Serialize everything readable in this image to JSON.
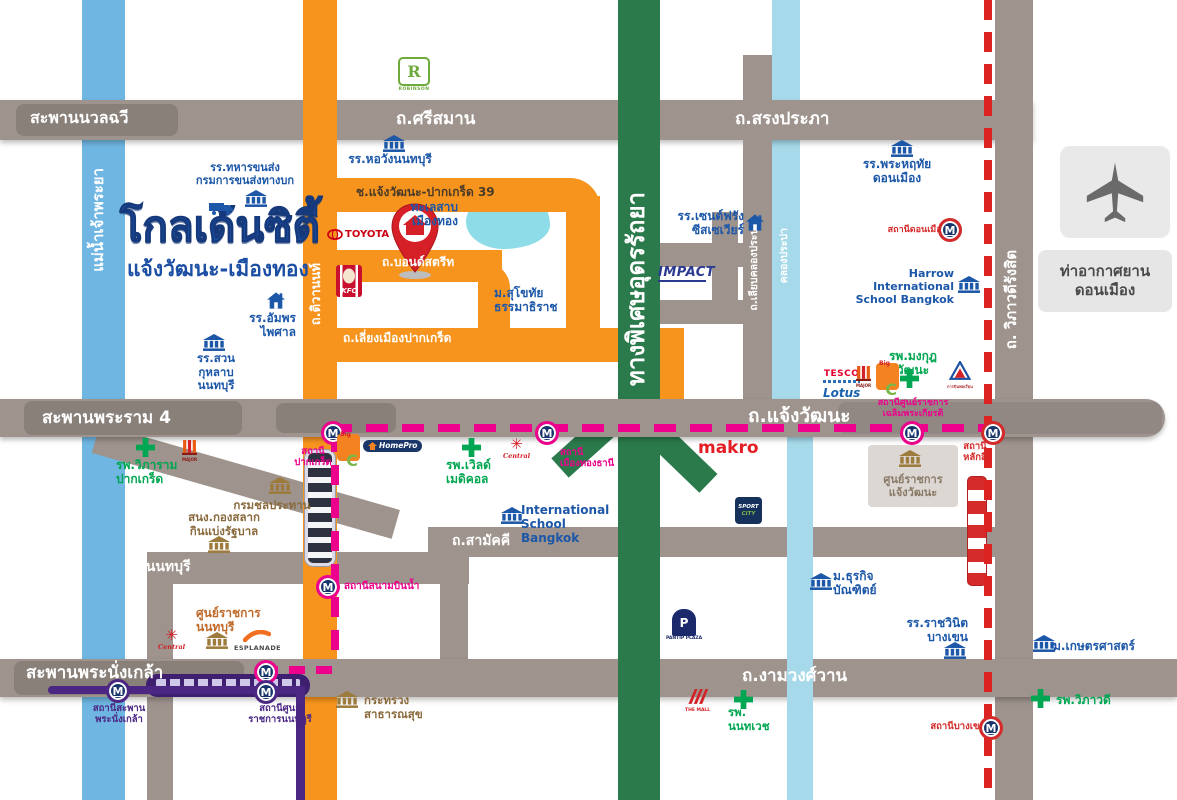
{
  "logo": {
    "title": "โกลเด้นซิตี้",
    "subtitle": "แจ้งวัฒนะ-เมืองทอง"
  },
  "airport": {
    "label": "ท่าอากาศยาน\nดอนเมือง"
  },
  "colors": {
    "white": "#ffffff",
    "road": "#9e938d",
    "orange": "#f7941e",
    "green": "#2b7a4b",
    "river": "#6fb6e2",
    "canal": "#a6d9ea",
    "pink": "#ec008c",
    "purple": "#4b2683",
    "red": "#d42a2a",
    "blue": "#1c57a8",
    "hospital": "#00a651",
    "gov": "#8a6a3c"
  },
  "labels": [
    {
      "id": "bridge-nuanchawee-label",
      "t": "สะพานนวลฉวี",
      "x": 30,
      "y": 109,
      "s": 16,
      "c": "white"
    },
    {
      "id": "road-srisaman-label",
      "t": "ถ.ศรีสมาน",
      "x": 396,
      "y": 109,
      "s": 17,
      "c": "white"
    },
    {
      "id": "road-songprapha-label",
      "t": "ถ.สรงประภา",
      "x": 735,
      "y": 109,
      "s": 17,
      "c": "white"
    },
    {
      "id": "bridge-rama4-label",
      "t": "สะพานพระราม 4",
      "x": 42,
      "y": 408,
      "s": 17,
      "c": "white"
    },
    {
      "id": "road-chaengwattana-label",
      "t": "ถ.แจ้งวัฒนะ",
      "x": 748,
      "y": 405,
      "s": 19,
      "c": "white"
    },
    {
      "id": "road-samakkhi-label",
      "t": "ถ.สามัคคี",
      "x": 452,
      "y": 533,
      "s": 14,
      "c": "white"
    },
    {
      "id": "road-nonthaburi-label",
      "t": "ถ.นนทบุรี",
      "x": 132,
      "y": 559,
      "s": 14,
      "c": "white"
    },
    {
      "id": "bridge-phranangklao-label",
      "t": "สะพานพระนั่งเกล้า",
      "x": 26,
      "y": 663,
      "s": 17,
      "c": "white"
    },
    {
      "id": "road-ngamwongwan-label",
      "t": "ถ.งามวงศ์วาน",
      "x": 742,
      "y": 666,
      "s": 17,
      "c": "white"
    },
    {
      "id": "road-soi39-label",
      "t": "ช.แจ้งวัฒนะ-ปากเกร็ด 39",
      "x": 356,
      "y": 185,
      "s": 12,
      "c": "#4a3b28"
    },
    {
      "id": "road-bondstreet-label",
      "t": "ถ.บอนด์สตรีท",
      "x": 382,
      "y": 255,
      "s": 12,
      "c": "white"
    },
    {
      "id": "road-liangmueang-label",
      "t": "ถ.เลี่ยงเมืองปากเกร็ด",
      "x": 343,
      "y": 331,
      "s": 12,
      "c": "white"
    },
    {
      "id": "river-chaophraya-label",
      "t": "แม่น้ำเจ้าพระยา",
      "x": 90,
      "y": 168,
      "s": 15,
      "c": "white",
      "rot": 1
    },
    {
      "id": "road-tiwanon-label",
      "t": "ถ.ติวานนท์",
      "x": 309,
      "y": 263,
      "s": 13,
      "c": "white",
      "rot": 1
    },
    {
      "id": "expressway-udonratthaya-label",
      "t": "ทางพิเศษอุดรรัถยา",
      "x": 622,
      "y": 192,
      "s": 24,
      "c": "white",
      "rot": 1
    },
    {
      "id": "road-liabklongprapa-label",
      "t": "ถ.เลียบคลองประปา",
      "x": 748,
      "y": 222,
      "s": 10.5,
      "c": "white",
      "rot": 1
    },
    {
      "id": "canal-klongprapa-label",
      "t": "คลองประปา",
      "x": 778,
      "y": 228,
      "s": 10.5,
      "c": "white",
      "rot": 1
    },
    {
      "id": "road-vibhavadi-label",
      "t": "ถ. วิภาวดีรังสิต",
      "x": 1003,
      "y": 250,
      "s": 15,
      "c": "white",
      "rot": 1
    },
    {
      "id": "landmark-horwang-school",
      "t": "รร.หอวังนนทบุรี",
      "x": 340,
      "y": 152,
      "w": 100,
      "s": 12,
      "c": "blue",
      "a": "center"
    },
    {
      "id": "landmark-military-transport-school",
      "t": "รร.ทหารขนส่ง\nกรมการขนส่งทางบก",
      "x": 188,
      "y": 162,
      "w": 114,
      "s": 11,
      "c": "blue",
      "a": "center"
    },
    {
      "id": "landmark-phrahruethai-school",
      "t": "รร.พระหฤทัย\nดอนเมือง",
      "x": 853,
      "y": 157,
      "w": 88,
      "s": 12,
      "c": "blue",
      "a": "center"
    },
    {
      "id": "landmark-stfrancis-school",
      "t": "รร.เซนต์ฟรัง\nซีสเซเวียร์",
      "x": 664,
      "y": 209,
      "w": 80,
      "s": 12,
      "c": "blue",
      "a": "right"
    },
    {
      "id": "landmark-harrow-school",
      "t": "Harrow International\nSchool Bangkok",
      "x": 834,
      "y": 268,
      "w": 120,
      "s": 11,
      "c": "blue",
      "a": "right"
    },
    {
      "id": "landmark-sukhothai-university",
      "t": "ม.สุโขทัย\nธรรมาธิราช",
      "x": 494,
      "y": 286,
      "w": 72,
      "s": 12,
      "c": "blue"
    },
    {
      "id": "landmark-amphon-school",
      "t": "รร.อัมพร\nไพศาล",
      "x": 228,
      "y": 311,
      "w": 68,
      "s": 12,
      "c": "blue",
      "a": "right"
    },
    {
      "id": "landmark-suankularb-school",
      "t": "รร.สวน\nกุหลาบ\nนนทบุรี",
      "x": 186,
      "y": 352,
      "w": 60,
      "s": 11.5,
      "c": "blue",
      "a": "center"
    },
    {
      "id": "landmark-muangthong-lake",
      "t": "ทะเลสาบ\nเมืองทอง",
      "x": 394,
      "y": 200,
      "w": 64,
      "s": 12,
      "c": "blue",
      "a": "right"
    },
    {
      "id": "landmark-isb-school",
      "t": "International\nSchool Bangkok",
      "x": 521,
      "y": 503,
      "w": 95,
      "s": 12,
      "c": "blue"
    },
    {
      "id": "landmark-dhurakij-university",
      "t": "ม.ธุรกิจ\nบัณฑิตย์",
      "x": 833,
      "y": 569,
      "w": 58,
      "s": 12,
      "c": "blue"
    },
    {
      "id": "landmark-rajavinit-school",
      "t": "รร.ราชวินิต\nบางเขน",
      "x": 896,
      "y": 616,
      "w": 72,
      "s": 12,
      "c": "blue",
      "a": "right"
    },
    {
      "id": "landmark-kasetsart-university",
      "t": "ม.เกษตรศาสตร์",
      "x": 1053,
      "y": 639,
      "w": 100,
      "s": 12,
      "c": "blue"
    },
    {
      "id": "landmark-viphuram-hospital",
      "t": "รพ.วิภาราม\nปากเกร็ด",
      "x": 116,
      "y": 458,
      "w": 74,
      "s": 12,
      "c": "hospital"
    },
    {
      "id": "landmark-worldmedical-hospital",
      "t": "รพ.เวิลด์\nเมดิคอล",
      "x": 446,
      "y": 458,
      "w": 62,
      "s": 12,
      "c": "hospital"
    },
    {
      "id": "landmark-mongkut-hospital",
      "t": "รพ.มงกุฎ\nวัฒนะ",
      "x": 882,
      "y": 349,
      "w": 62,
      "s": 12,
      "c": "hospital",
      "a": "center"
    },
    {
      "id": "landmark-nonthavej-hospital",
      "t": "รพ.\nนนทเวช",
      "x": 728,
      "y": 706,
      "w": 50,
      "s": 11.5,
      "c": "hospital"
    },
    {
      "id": "landmark-vibhavadi-hospital",
      "t": "รพ.วิภาวดี",
      "x": 1056,
      "y": 693,
      "w": 72,
      "s": 12,
      "c": "hospital"
    },
    {
      "id": "landmark-royal-irrigation",
      "t": "กรมชลประทาน",
      "x": 222,
      "y": 499,
      "w": 100,
      "s": 11.5,
      "c": "gov",
      "a": "center"
    },
    {
      "id": "landmark-lottery-office",
      "t": "สนง.กองสลาก\nกินแบ่งรัฐบาล",
      "x": 180,
      "y": 511,
      "w": 88,
      "s": 11.5,
      "c": "gov",
      "a": "center"
    },
    {
      "id": "landmark-health-ministry",
      "t": "กระทรวง\nสาธารณสุข",
      "x": 364,
      "y": 694,
      "w": 72,
      "s": 11.5,
      "c": "gov"
    },
    {
      "id": "landmark-government-complex-cw",
      "t": "ศูนย์ราชการ\nแจ้งวัฒนะ",
      "x": 872,
      "y": 474,
      "w": 82,
      "s": 11,
      "c": "#8a7a66",
      "a": "center"
    },
    {
      "id": "landmark-government-complex-nb",
      "t": "ศูนย์ราชการ\nนนทบุรี",
      "x": 196,
      "y": 606,
      "w": 72,
      "s": 12,
      "c": "#c06a2a"
    },
    {
      "id": "station-pakkred-label",
      "t": "สถานี\nปากเกร็ด",
      "x": 291,
      "y": 446,
      "w": 44,
      "s": 9.5,
      "c": "pink",
      "a": "center"
    },
    {
      "id": "station-mueangthongthani-label",
      "t": "สถานี\nเมืองทองธานี",
      "x": 560,
      "y": 447,
      "w": 62,
      "s": 9.5,
      "c": "pink"
    },
    {
      "id": "station-chalermprakiat-label",
      "t": "สถานีศูนย์ราชการ\nเฉลิมพระเกียรติ",
      "x": 866,
      "y": 398,
      "w": 94,
      "s": 9,
      "c": "pink",
      "a": "center"
    },
    {
      "id": "station-sanambinnam-label",
      "t": "สถานีสนามบินน้ำ",
      "x": 344,
      "y": 581,
      "w": 92,
      "s": 10,
      "c": "pink"
    },
    {
      "id": "station-phranangklao-label",
      "t": "สถานีสะพาน\nพระนั่งเกล้า",
      "x": 82,
      "y": 703,
      "w": 74,
      "s": 9.5,
      "c": "purple",
      "a": "center"
    },
    {
      "id": "station-civic-nonthaburi-label",
      "t": "สถานีศูนย์\nราชการนนทบุรี",
      "x": 236,
      "y": 703,
      "w": 88,
      "s": 9.5,
      "c": "purple",
      "a": "center"
    },
    {
      "id": "station-donmueang-label",
      "t": "สถานีดอนเมือง",
      "x": 882,
      "y": 225,
      "w": 64,
      "s": 9,
      "c": "red",
      "a": "right"
    },
    {
      "id": "station-laksi-label",
      "t": "สถานี\nหลักสี่",
      "x": 954,
      "y": 441,
      "w": 42,
      "s": 9.5,
      "c": "red",
      "a": "center"
    },
    {
      "id": "station-bangkhen-label",
      "t": "สถานีบางเขน",
      "x": 922,
      "y": 721,
      "w": 64,
      "s": 9.5,
      "c": "red",
      "a": "right"
    },
    {
      "id": "logo-makro",
      "t": "makro",
      "x": 698,
      "y": 438,
      "s": 17,
      "c": "#e31e24",
      "weight": "800"
    }
  ],
  "icons": [
    {
      "id": "bank-icon-horwang",
      "kind": "bank",
      "x": 383,
      "y": 135,
      "c": "blue"
    },
    {
      "id": "bank-icon-military-transport",
      "kind": "bank",
      "x": 245,
      "y": 190,
      "c": "blue"
    },
    {
      "id": "bank-icon-phrahruethai",
      "kind": "bank",
      "x": 891,
      "y": 140,
      "c": "blue"
    },
    {
      "id": "bank-icon-harrow",
      "kind": "bank",
      "x": 958,
      "y": 276,
      "c": "blue"
    },
    {
      "id": "bank-icon-suankularb",
      "kind": "bank",
      "x": 203,
      "y": 334,
      "c": "blue"
    },
    {
      "id": "bank-icon-isb",
      "kind": "bank",
      "x": 501,
      "y": 507,
      "c": "blue"
    },
    {
      "id": "bank-icon-dhurakij",
      "kind": "bank",
      "x": 810,
      "y": 573,
      "c": "blue"
    },
    {
      "id": "bank-icon-rajavinit",
      "kind": "bank",
      "x": 944,
      "y": 642,
      "c": "blue"
    },
    {
      "id": "bank-icon-kasetsart",
      "kind": "bank",
      "x": 1033,
      "y": 635,
      "c": "blue"
    },
    {
      "id": "house-icon-stfrancis",
      "kind": "house",
      "x": 746,
      "y": 214,
      "c": "blue"
    },
    {
      "id": "house-icon-amphon",
      "kind": "house",
      "x": 267,
      "y": 292,
      "c": "blue"
    },
    {
      "id": "bank-icon-irrigation",
      "kind": "bank",
      "x": 269,
      "y": 477,
      "c": "gov"
    },
    {
      "id": "bank-icon-lottery",
      "kind": "bank",
      "x": 208,
      "y": 536,
      "c": "gov"
    },
    {
      "id": "bank-icon-health-ministry",
      "kind": "bank",
      "x": 336,
      "y": 691,
      "c": "gov"
    },
    {
      "id": "bank-icon-govcomplex-cw",
      "kind": "bank",
      "x": 899,
      "y": 450,
      "c": "gov"
    },
    {
      "id": "bank-icon-govcomplex-nb",
      "kind": "bank",
      "x": 206,
      "y": 632,
      "c": "gov"
    },
    {
      "id": "cross-icon-viphuram",
      "kind": "cross",
      "x": 136,
      "y": 438
    },
    {
      "id": "cross-icon-worldmed",
      "kind": "cross",
      "x": 462,
      "y": 438
    },
    {
      "id": "cross-icon-mongkut",
      "kind": "cross",
      "x": 900,
      "y": 369
    },
    {
      "id": "cross-icon-nonthavej",
      "kind": "cross",
      "x": 734,
      "y": 690
    },
    {
      "id": "cross-icon-vibhavadi",
      "kind": "cross",
      "x": 1031,
      "y": 689
    },
    {
      "id": "m-station-icon-pakkred",
      "kind": "m",
      "x": 321,
      "y": 421,
      "c": "pink"
    },
    {
      "id": "m-station-icon-mueangthong",
      "kind": "m",
      "x": 535,
      "y": 421,
      "c": "pink"
    },
    {
      "id": "m-station-icon-chalermprakiat",
      "kind": "m",
      "x": 900,
      "y": 421,
      "c": "pink"
    },
    {
      "id": "m-station-icon-sanambinnam",
      "kind": "m",
      "x": 316,
      "y": 575,
      "c": "pink"
    },
    {
      "id": "m-station-icon-civicnon-pink",
      "kind": "m",
      "x": 254,
      "y": 660,
      "c": "pink"
    },
    {
      "id": "m-station-icon-civicnon-purple",
      "kind": "m",
      "x": 254,
      "y": 680,
      "c": "purple"
    },
    {
      "id": "m-station-icon-phranangklao",
      "kind": "m",
      "x": 106,
      "y": 679,
      "c": "purple"
    },
    {
      "id": "m-station-icon-donmueang",
      "kind": "m",
      "x": 938,
      "y": 218,
      "c": "red"
    },
    {
      "id": "m-station-icon-laksi",
      "kind": "m",
      "x": 981,
      "y": 421,
      "c": "red"
    },
    {
      "id": "m-station-icon-bangkhen",
      "kind": "m",
      "x": 979,
      "y": 716,
      "c": "red"
    },
    {
      "id": "robinson-logo",
      "kind": "robinson",
      "x": 398,
      "y": 57,
      "text": "R",
      "text2": "ROBINSON"
    },
    {
      "id": "toyota-logo",
      "kind": "toyota",
      "x": 327,
      "y": 229,
      "text": "TOYOTA"
    },
    {
      "id": "kfc-logo",
      "kind": "kfc",
      "x": 336,
      "y": 265,
      "text": "KFC"
    },
    {
      "id": "impact-logo",
      "kind": "impact",
      "x": 658,
      "y": 263,
      "text": "IMPACT"
    },
    {
      "id": "tesco-lotus-logo",
      "kind": "tesco",
      "x": 823,
      "y": 363,
      "text": "TESCO",
      "text2": "Lotus"
    },
    {
      "id": "major-cineplex-logo-north",
      "kind": "major",
      "x": 856,
      "y": 366,
      "text": "MAJOR"
    },
    {
      "id": "bigc-logo-north",
      "kind": "bigc",
      "x": 876,
      "y": 363,
      "text": "Big",
      "text2": "C"
    },
    {
      "id": "civil-aviation-logo",
      "kind": "catc",
      "x": 947,
      "y": 361,
      "text": "การบินพลเรือน"
    },
    {
      "id": "major-cineplex-logo-west",
      "kind": "major",
      "x": 182,
      "y": 440,
      "text": "MAJOR"
    },
    {
      "id": "bigc-logo-west",
      "kind": "bigc",
      "x": 337,
      "y": 434,
      "text": "Big",
      "text2": "C"
    },
    {
      "id": "homepro-logo",
      "kind": "homepro",
      "x": 363,
      "y": 440,
      "text": "HomePro"
    },
    {
      "id": "central-logo-worldmed",
      "kind": "central",
      "x": 503,
      "y": 437,
      "text": "Central"
    },
    {
      "id": "central-logo-civicnb",
      "kind": "central",
      "x": 158,
      "y": 628,
      "text": "Central"
    },
    {
      "id": "esplanade-logo",
      "kind": "esplanade",
      "x": 234,
      "y": 629,
      "text": "ESPLANADE"
    },
    {
      "id": "sportcity-logo",
      "kind": "sportcity",
      "x": 735,
      "y": 497,
      "text": "SPORT",
      "text2": "CITY"
    },
    {
      "id": "pantip-logo",
      "kind": "pantip",
      "x": 666,
      "y": 609,
      "text": "P",
      "text2": "PANTIP PLAZA"
    },
    {
      "id": "themall-logo",
      "kind": "themall",
      "x": 685,
      "y": 689,
      "text": "THE MALL"
    },
    {
      "id": "truck-icon-military-transport",
      "kind": "truck",
      "x": 209,
      "y": 202
    }
  ]
}
